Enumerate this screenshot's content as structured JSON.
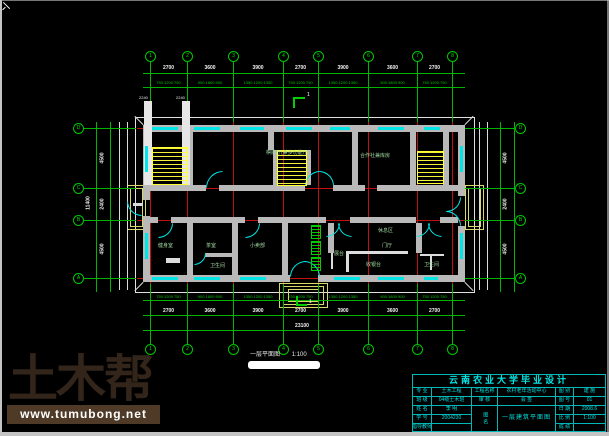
{
  "colors": {
    "background": "#000000",
    "grid_green": "#00c800",
    "axis_red": "#c01010",
    "wall_gray": "#b9b9b9",
    "glass_cyan": "#00e6e6",
    "stair_yellow": "#ffff33",
    "title_cyan": "#00e0e0",
    "logo_brown": "#33251a",
    "bar_brown": "#4e3a27"
  },
  "drawing": {
    "caption": {
      "title": "一层平面图",
      "scale": "1:100"
    },
    "section_label": "1",
    "axes": {
      "x": [
        150,
        187,
        233,
        283,
        318,
        368,
        417,
        452
      ],
      "x_labels": [
        "1",
        "2",
        "3",
        "4",
        "5",
        "6",
        "7",
        "8"
      ],
      "y": [
        128,
        188,
        220,
        278
      ],
      "y_labels": [
        "D",
        "C",
        "B",
        "A"
      ]
    },
    "dims": {
      "major": [
        "2700",
        "3600",
        "3900",
        "2700",
        "3900",
        "3600",
        "2700"
      ],
      "fine": [
        "750 1200 750",
        "900 1800 900",
        "1350 1200 1350",
        "750 1200 750",
        "1350 1200 1350",
        "900 1800 900",
        "750 1200 750"
      ],
      "overall": "23100",
      "side_major": [
        "4500",
        "2400",
        "4500"
      ],
      "side_overall": "11400"
    },
    "rooms": [
      {
        "t": "棋牌厅(兼多功能厅)",
        "x": 266,
        "y": 151
      },
      {
        "t": "合作社兼库房",
        "x": 360,
        "y": 154
      },
      {
        "t": "健身室",
        "x": 158,
        "y": 244
      },
      {
        "t": "茶室",
        "x": 206,
        "y": 244
      },
      {
        "t": "小卖部",
        "x": 250,
        "y": 244
      },
      {
        "t": "卫生间",
        "x": 210,
        "y": 264
      },
      {
        "t": "休息区",
        "x": 378,
        "y": 229
      },
      {
        "t": "门厅",
        "x": 382,
        "y": 244
      },
      {
        "t": "展台",
        "x": 334,
        "y": 252
      },
      {
        "t": "收银台",
        "x": 366,
        "y": 263
      },
      {
        "t": "卫生间",
        "x": 424,
        "y": 263
      }
    ],
    "col_labels": [
      {
        "t": "2240",
        "x": 139,
        "y": 96
      },
      {
        "t": "2240",
        "x": 176,
        "y": 96
      }
    ],
    "geometry": {
      "windows": {
        "top": [
          [
            152,
            26
          ],
          [
            194,
            26
          ],
          [
            240,
            24
          ],
          [
            286,
            26
          ],
          [
            330,
            20
          ],
          [
            378,
            26
          ],
          [
            424,
            16
          ]
        ],
        "bottom": [
          [
            152,
            26
          ],
          [
            194,
            26
          ],
          [
            240,
            26
          ],
          [
            334,
            26
          ],
          [
            378,
            26
          ],
          [
            424,
            14
          ]
        ],
        "left": [
          [
            146,
            26
          ],
          [
            233,
            26
          ]
        ],
        "right": [
          [
            146,
            26
          ],
          [
            233,
            26
          ]
        ]
      },
      "doors": [
        [
          206,
          171,
          15,
          0
        ],
        [
          305,
          171,
          13,
          0
        ],
        [
          319,
          171,
          13,
          90
        ],
        [
          158,
          223,
          13,
          180
        ],
        [
          245,
          223,
          13,
          180
        ],
        [
          326,
          223,
          12,
          180
        ],
        [
          338,
          223,
          12,
          270
        ],
        [
          416,
          223,
          12,
          180
        ],
        [
          428,
          223,
          12,
          270
        ],
        [
          290,
          261,
          14,
          0
        ],
        [
          304,
          261,
          14,
          90
        ],
        [
          446,
          197,
          13,
          180
        ],
        [
          446,
          211,
          13,
          90
        ],
        [
          127,
          201,
          13,
          270
        ],
        [
          194,
          253,
          10,
          180
        ]
      ],
      "stairs": [
        [
          152,
          147,
          34,
          36
        ],
        [
          277,
          150,
          28,
          34
        ],
        [
          417,
          151,
          25,
          31
        ]
      ],
      "radiators": [
        [
          311,
          225
        ],
        [
          311,
          241
        ],
        [
          311,
          257
        ]
      ]
    }
  },
  "title_block": {
    "title": "云南农业大学毕业设计",
    "r1": {
      "c1": "专 业",
      "c2": "土木工程",
      "c3": "工程名称",
      "c4": "农村老年活动中心",
      "c5": "图 别",
      "c6": "建 施"
    },
    "r2": {
      "c1": "班 级",
      "c2": "04级土木班",
      "c3": "审 核",
      "c4": "会 签",
      "c5": "图 号",
      "c6": "01"
    },
    "r3": {
      "c1": "姓 名",
      "c2": "李 明",
      "c5": "日 期",
      "c6": "2008.6"
    },
    "r4": {
      "c1": "学 号",
      "c2": "2004230",
      "c5": "比 例",
      "c6": "1:100"
    },
    "r5": {
      "c1": "指导教师",
      "c2": "",
      "c5": "成 绩",
      "c6": ""
    },
    "merged_label": "图名",
    "merged_value": "一层建筑平面图"
  },
  "watermark": {
    "logo": "土木帮",
    "site": "www.tumubong.net"
  }
}
